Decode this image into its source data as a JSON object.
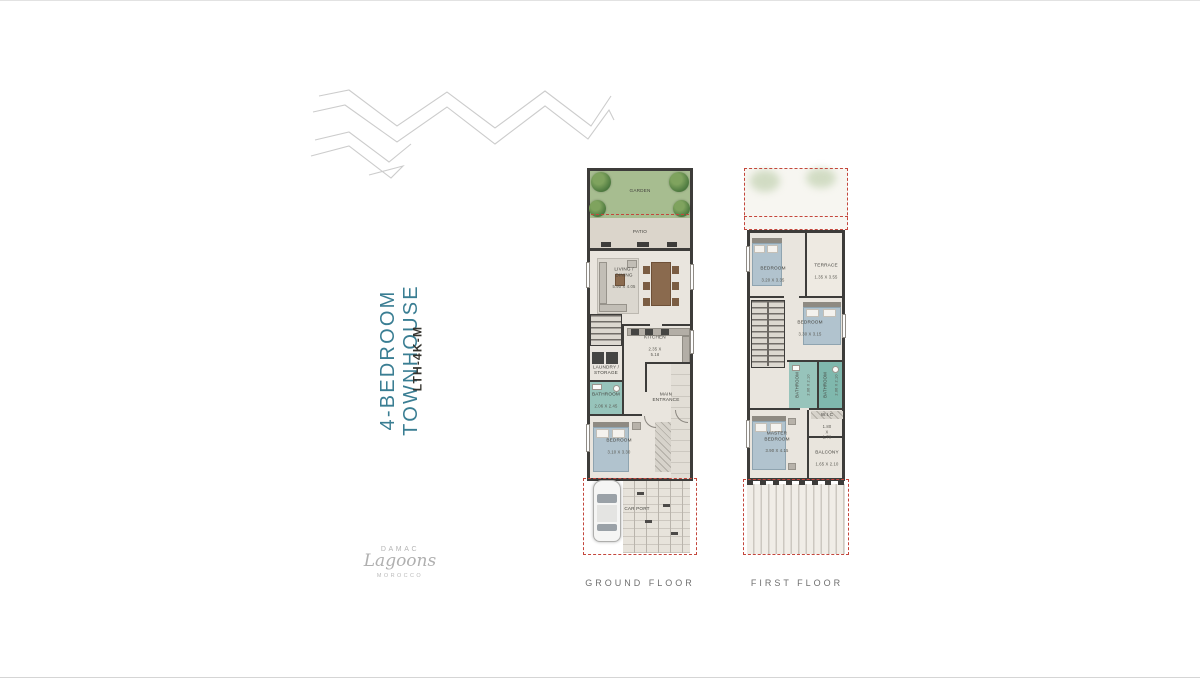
{
  "page": {
    "title": "4-BEDROOM TOWNHOUSE",
    "code": "LTH-4K-M"
  },
  "brand": {
    "name": "DAMAC",
    "product": "Lagoons",
    "region": "MOROCCO"
  },
  "colors": {
    "accent": "#3a7e93",
    "wall": "#3d3c3a",
    "floor": "#e9e5de",
    "garden": "#a7bd90",
    "bathroom_teal": "#97c4bb",
    "boundary_red": "#c4463c",
    "logo_gray": "#b4b4b4"
  },
  "gf": {
    "caption": "GROUND FLOOR",
    "garden": {
      "name": "GARDEN"
    },
    "patio": {
      "name": "PATIO"
    },
    "living": {
      "name": "LIVING / DINING",
      "dims": "5.90 X 4.05"
    },
    "kitchen": {
      "name": "KITCHEN",
      "dims": "2.35 X 5.18"
    },
    "laundry": {
      "name": "LAUNDRY /\nSTORAGE"
    },
    "bath": {
      "name": "BATHROOM",
      "dims": "2.06 X 2.45"
    },
    "entrance": {
      "name": "MAIN\nENTRANCE"
    },
    "bedroom": {
      "name": "BEDROOM",
      "dims": "3.10 X 3.30"
    },
    "carport": {
      "name": "CAR PORT"
    }
  },
  "ff": {
    "caption": "FIRST FLOOR",
    "bedroom2": {
      "name": "BEDROOM",
      "dims": "3.20 X 3.35"
    },
    "terrace": {
      "name": "TERRACE",
      "dims": "1.35 X 3.55"
    },
    "bedroom3": {
      "name": "BEDROOM",
      "dims": "3.30 X 3.15"
    },
    "bath2": {
      "name": "BATHROOM",
      "dims": "2.06 X 2.10"
    },
    "bath3": {
      "name": "BATHROOM",
      "dims": "2.06 X 2.10"
    },
    "master": {
      "name": "MASTER\nBEDROOM",
      "dims": "3.90 X 4.15"
    },
    "wic": {
      "name": "W.I.C",
      "dims": "1.80 X 1.70"
    },
    "balcony": {
      "name": "BALCONY",
      "dims": "1.65 X 2.10"
    }
  }
}
